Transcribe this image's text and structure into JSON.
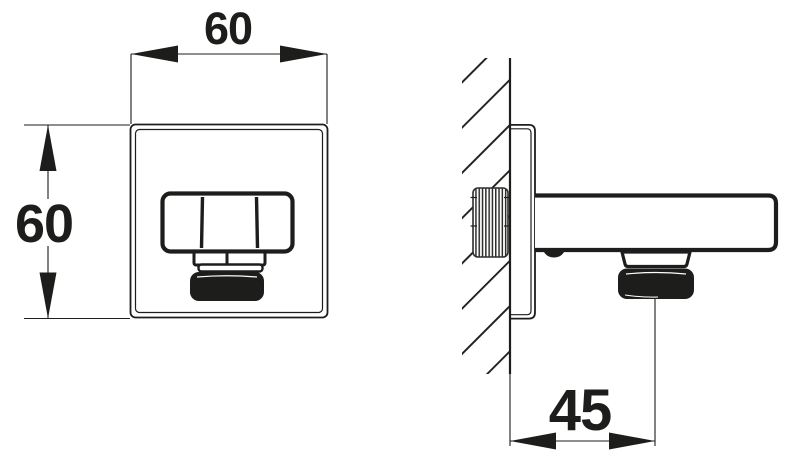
{
  "drawing": {
    "colors": {
      "ink": "#1d1d1b",
      "paper": "#ffffff",
      "thread_gray": "#2e2e2c"
    },
    "views": {
      "front": {
        "width_label": "60",
        "height_label": "60"
      },
      "side": {
        "offset_label": "45"
      }
    }
  }
}
